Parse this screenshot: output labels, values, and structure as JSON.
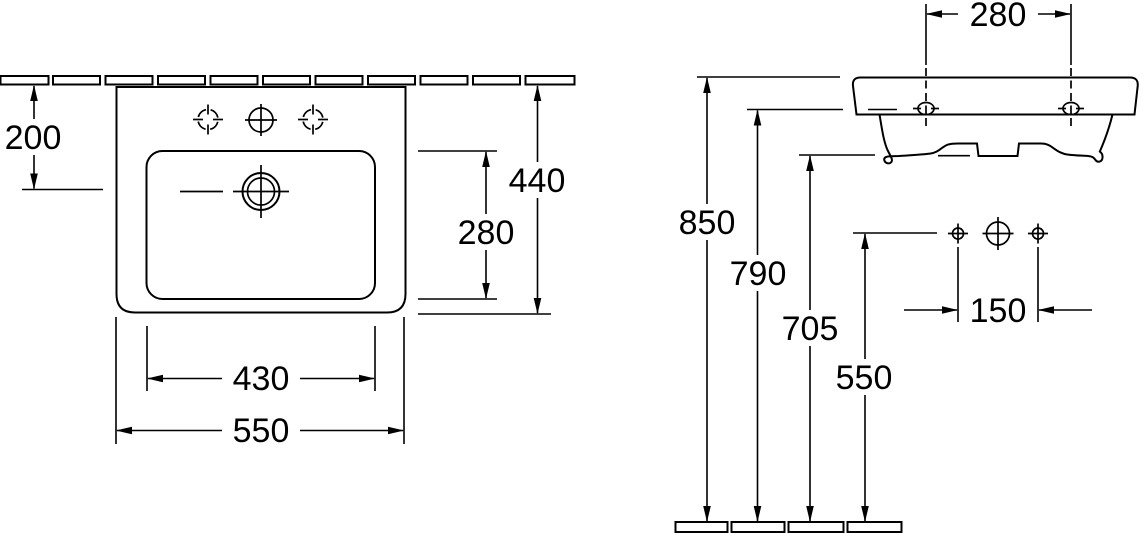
{
  "meta": {
    "drawing_type": "washbasin installation technical drawing",
    "units": "mm"
  },
  "colors": {
    "line": "#000000",
    "background": "#ffffff"
  },
  "plan_view": {
    "dims": {
      "wall_to_drain": "200",
      "basin_depth_outer": "440",
      "basin_depth_inner": "280",
      "basin_width_inner": "430",
      "basin_width_outer": "550"
    }
  },
  "front_view": {
    "dims": {
      "fixing_hole_spacing": "280",
      "rim_height": "850",
      "rim_underside_height": "790",
      "outlet_height": "705",
      "tap_hole_height": "550",
      "tap_hole_spacing": "150"
    }
  }
}
